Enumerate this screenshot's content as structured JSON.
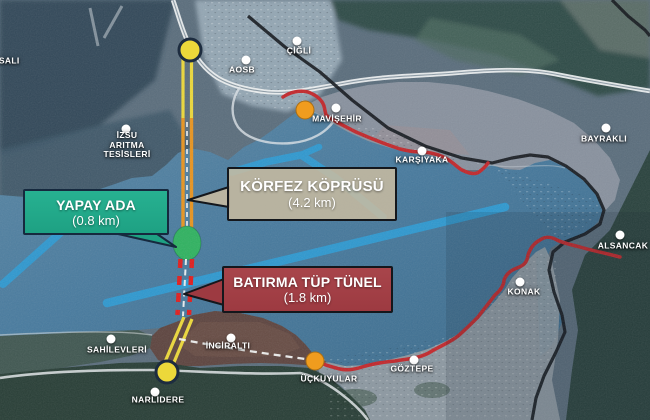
{
  "callouts": {
    "yapay_ada": {
      "title": "YAPAY ADA",
      "length": "(0.8 km)",
      "fill": "#1ea183"
    },
    "korfez_koprusu": {
      "title": "KÖRFEZ KÖPRÜSÜ",
      "length": "(4.2 km)",
      "fill": "rgba(202,188,160,0.85)"
    },
    "batirma_tup_tunel": {
      "title": "BATIRMA TÜP TÜNEL",
      "length": "(1.8 km)",
      "fill": "#9d3a41"
    }
  },
  "places": [
    {
      "id": "sasali",
      "label": "SASALI",
      "x": 3,
      "y": 61
    },
    {
      "id": "cigli",
      "label": "ÇİĞLİ",
      "x": 299,
      "y": 51,
      "dot": {
        "x": 297,
        "y": 41
      }
    },
    {
      "id": "aosb",
      "label": "AOSB",
      "x": 242,
      "y": 70,
      "dot": {
        "x": 246,
        "y": 60
      }
    },
    {
      "id": "izsu",
      "lines": [
        "İZSU",
        "ARITMA",
        "TESİSLERİ"
      ],
      "x": 127,
      "y": 145,
      "dot": {
        "x": 126,
        "y": 129
      }
    },
    {
      "id": "mavisehir",
      "label": "MAVİŞEHİR",
      "x": 337,
      "y": 119,
      "dot": {
        "x": 336,
        "y": 108
      }
    },
    {
      "id": "karsiyaka",
      "label": "KARŞIYAKA",
      "x": 422,
      "y": 160,
      "dot": {
        "x": 422,
        "y": 151
      }
    },
    {
      "id": "bayrakli",
      "label": "BAYRAKLI",
      "x": 604,
      "y": 139,
      "dot": {
        "x": 606,
        "y": 128
      }
    },
    {
      "id": "alsancak",
      "label": "ALSANCAK",
      "x": 623,
      "y": 246,
      "dot": {
        "x": 620,
        "y": 235
      }
    },
    {
      "id": "konak",
      "label": "KONAK",
      "x": 524,
      "y": 292,
      "dot": {
        "x": 520,
        "y": 282
      }
    },
    {
      "id": "goztepe",
      "label": "GÖZTEPE",
      "x": 412,
      "y": 369,
      "dot": {
        "x": 414,
        "y": 360
      }
    },
    {
      "id": "uckuyular",
      "label": "ÜÇKUYULAR",
      "x": 329,
      "y": 379
    },
    {
      "id": "inciralti",
      "label": "İNCİRALTI",
      "x": 228,
      "y": 346,
      "dot": {
        "x": 231,
        "y": 338
      }
    },
    {
      "id": "sahilevleri",
      "label": "SAHİLEVLERİ",
      "x": 117,
      "y": 350,
      "dot": {
        "x": 111,
        "y": 339
      }
    },
    {
      "id": "narlidere",
      "label": "NARLIDERE",
      "x": 158,
      "y": 400,
      "dot": {
        "x": 155,
        "y": 392
      }
    }
  ],
  "markers": {
    "orange_junctions": [
      {
        "id": "mavisehir-junction",
        "x": 305,
        "y": 110
      },
      {
        "id": "uckuyular-junction",
        "x": 315,
        "y": 361
      }
    ],
    "route_endpoints": [
      {
        "id": "north-portal",
        "x": 190,
        "y": 50
      },
      {
        "id": "south-portal",
        "x": 167,
        "y": 372
      }
    ]
  },
  "colors": {
    "sea": "#45759a",
    "island_green": "#2fb260",
    "bridge_orange": "#e8941f",
    "approach_yellow": "#ecd83a",
    "tunnel_red": "#e01d1d",
    "coastal_route_red": "#c2272b",
    "marker_orange": "#f09c1e",
    "planned_blue": "#2d9bd4",
    "railway_black": "#14181d",
    "highway_white": "#eef1f2"
  }
}
